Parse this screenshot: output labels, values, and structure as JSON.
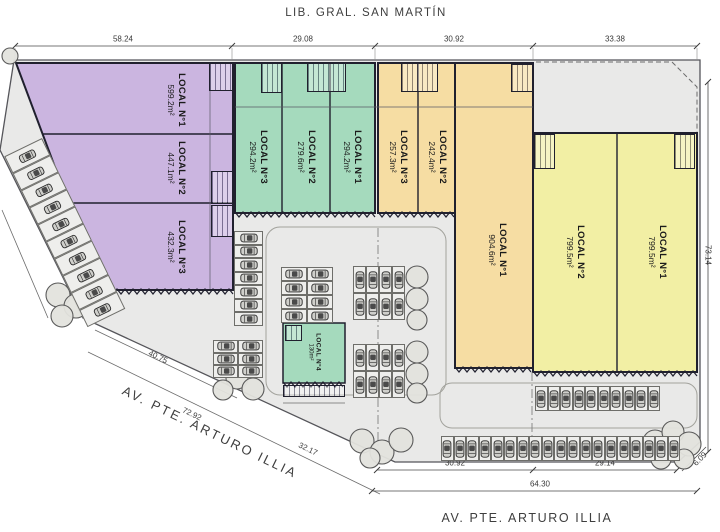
{
  "title_top": "LIB. GRAL. SAN MARTÍN",
  "street_diagonal": "AV. PTE. ARTURO ILLIA",
  "street_bottom": "AV. PTE. ARTURO ILLIA",
  "buildings": {
    "purple": {
      "units": [
        {
          "name": "LOCAL",
          "num": "N°1",
          "area": "599.2m²"
        },
        {
          "name": "LOCAL",
          "num": "N°2",
          "area": "447.1m²"
        },
        {
          "name": "LOCAL",
          "num": "N°3",
          "area": "432.3m²"
        }
      ]
    },
    "green": {
      "units": [
        {
          "name": "LOCAL",
          "num": "N°3",
          "area": "294.2m²"
        },
        {
          "name": "LOCAL",
          "num": "N°2",
          "area": "279.6m²"
        },
        {
          "name": "LOCAL",
          "num": "N°1",
          "area": "294.2m²"
        }
      ]
    },
    "orange": {
      "units": [
        {
          "name": "LOCAL",
          "num": "N°3",
          "area": "257.3m²"
        },
        {
          "name": "LOCAL",
          "num": "N°2",
          "area": "242.4m²"
        },
        {
          "name": "LOCAL",
          "num": "N°1",
          "area": "904.6m²"
        }
      ]
    },
    "yellow": {
      "units": [
        {
          "name": "LOCAL",
          "num": "N°2",
          "area": "799.5m²"
        },
        {
          "name": "LOCAL",
          "num": "N°1",
          "area": "799.5m²"
        }
      ]
    },
    "pad": {
      "units": [
        {
          "name": "LOCAL",
          "num": "N°4",
          "area": "130m²"
        }
      ]
    }
  },
  "dims": {
    "top": {
      "y": 46,
      "x1": 15,
      "x2": 697,
      "ticks": [
        15,
        232,
        375,
        533,
        697
      ],
      "labels": [
        {
          "t": "58.24",
          "x": 123
        },
        {
          "t": "29.08",
          "x": 303
        },
        {
          "t": "30.92",
          "x": 454
        },
        {
          "t": "33.38",
          "x": 615
        }
      ]
    },
    "bottom1": {
      "y": 470,
      "x1": 377,
      "x2": 677,
      "ticks": [
        377,
        533,
        677
      ],
      "labels": [
        {
          "t": "30.92",
          "x": 455
        },
        {
          "t": "29.14",
          "x": 605
        }
      ]
    },
    "bottom2": {
      "y": 491,
      "x1": 372,
      "x2": 697,
      "ticks": [
        372,
        697
      ],
      "labels": [
        {
          "t": "64.30",
          "x": 540
        }
      ]
    },
    "right": {
      "x": 708,
      "y1": 82,
      "y2": 452,
      "label": "73.14",
      "ly": 255
    },
    "diagonal": [
      {
        "t": "40.75",
        "x": 158,
        "y": 357,
        "rot": 26
      },
      {
        "t": "72.92",
        "x": 192,
        "y": 414,
        "rot": 26
      },
      {
        "t": "32.17",
        "x": 308,
        "y": 449,
        "rot": 26
      }
    ],
    "corner": {
      "t": "6.09",
      "x": 700,
      "y": 459,
      "rot": -45
    }
  },
  "parking": [
    {
      "name": "angled-left-strip",
      "x": 42,
      "y": 138,
      "cols": 10,
      "rows": 1,
      "sw": 19,
      "sh": 42,
      "rot": 64,
      "car": "v"
    },
    {
      "name": "purple-east-column",
      "x": 234,
      "y": 231,
      "cols": 1,
      "rows": 7,
      "sw": 29,
      "sh": 13.5,
      "rot": 0,
      "car": "h"
    },
    {
      "name": "southwest-cluster",
      "x": 213,
      "y": 340,
      "cols": 2,
      "rows": 3,
      "sw": 25,
      "sh": 12.5,
      "rot": 0,
      "car": "h"
    },
    {
      "name": "center-cluster",
      "x": 281,
      "y": 267,
      "cols": 2,
      "rows": 4,
      "sw": 26,
      "sh": 14,
      "rot": 0,
      "car": "h"
    },
    {
      "name": "mid-east-upper",
      "x": 353,
      "y": 266,
      "cols": 4,
      "rows": 2,
      "sw": 13,
      "sh": 27,
      "rot": 0,
      "car": "v"
    },
    {
      "name": "mid-east-lower",
      "x": 353,
      "y": 344,
      "cols": 4,
      "rows": 2,
      "sw": 13,
      "sh": 27,
      "rot": 0,
      "car": "v"
    },
    {
      "name": "inner-south-row",
      "x": 535,
      "y": 386,
      "cols": 10,
      "rows": 1,
      "sw": 12.5,
      "sh": 25,
      "rot": 0,
      "car": "v"
    },
    {
      "name": "street-south-row",
      "x": 441,
      "y": 436,
      "cols": 19,
      "rows": 1,
      "sw": 12.6,
      "sh": 25,
      "rot": 0,
      "car": "v"
    }
  ],
  "trees": [
    {
      "x": 10,
      "y": 56,
      "r": 8
    },
    {
      "x": 58,
      "y": 295,
      "r": 12
    },
    {
      "x": 76,
      "y": 306,
      "r": 12
    },
    {
      "x": 62,
      "y": 316,
      "r": 11
    },
    {
      "x": 237,
      "y": 378,
      "r": 11
    },
    {
      "x": 223,
      "y": 390,
      "r": 10
    },
    {
      "x": 253,
      "y": 389,
      "r": 11
    },
    {
      "x": 417,
      "y": 277,
      "r": 11
    },
    {
      "x": 417,
      "y": 299,
      "r": 11
    },
    {
      "x": 417,
      "y": 320,
      "r": 10
    },
    {
      "x": 417,
      "y": 352,
      "r": 11
    },
    {
      "x": 417,
      "y": 374,
      "r": 11
    },
    {
      "x": 417,
      "y": 393,
      "r": 10
    },
    {
      "x": 362,
      "y": 441,
      "r": 12
    },
    {
      "x": 382,
      "y": 452,
      "r": 12
    },
    {
      "x": 401,
      "y": 440,
      "r": 12
    },
    {
      "x": 370,
      "y": 458,
      "r": 10
    },
    {
      "x": 655,
      "y": 442,
      "r": 12
    },
    {
      "x": 673,
      "y": 432,
      "r": 11
    },
    {
      "x": 689,
      "y": 444,
      "r": 12
    },
    {
      "x": 661,
      "y": 459,
      "r": 10
    },
    {
      "x": 684,
      "y": 459,
      "r": 10
    }
  ],
  "colors": {
    "purple": "#cbb5e0",
    "green": "#a5dabd",
    "orange": "#f6dda3",
    "yellow": "#f2efa4",
    "site": "#e9e9e8",
    "outline": "#20202e"
  }
}
